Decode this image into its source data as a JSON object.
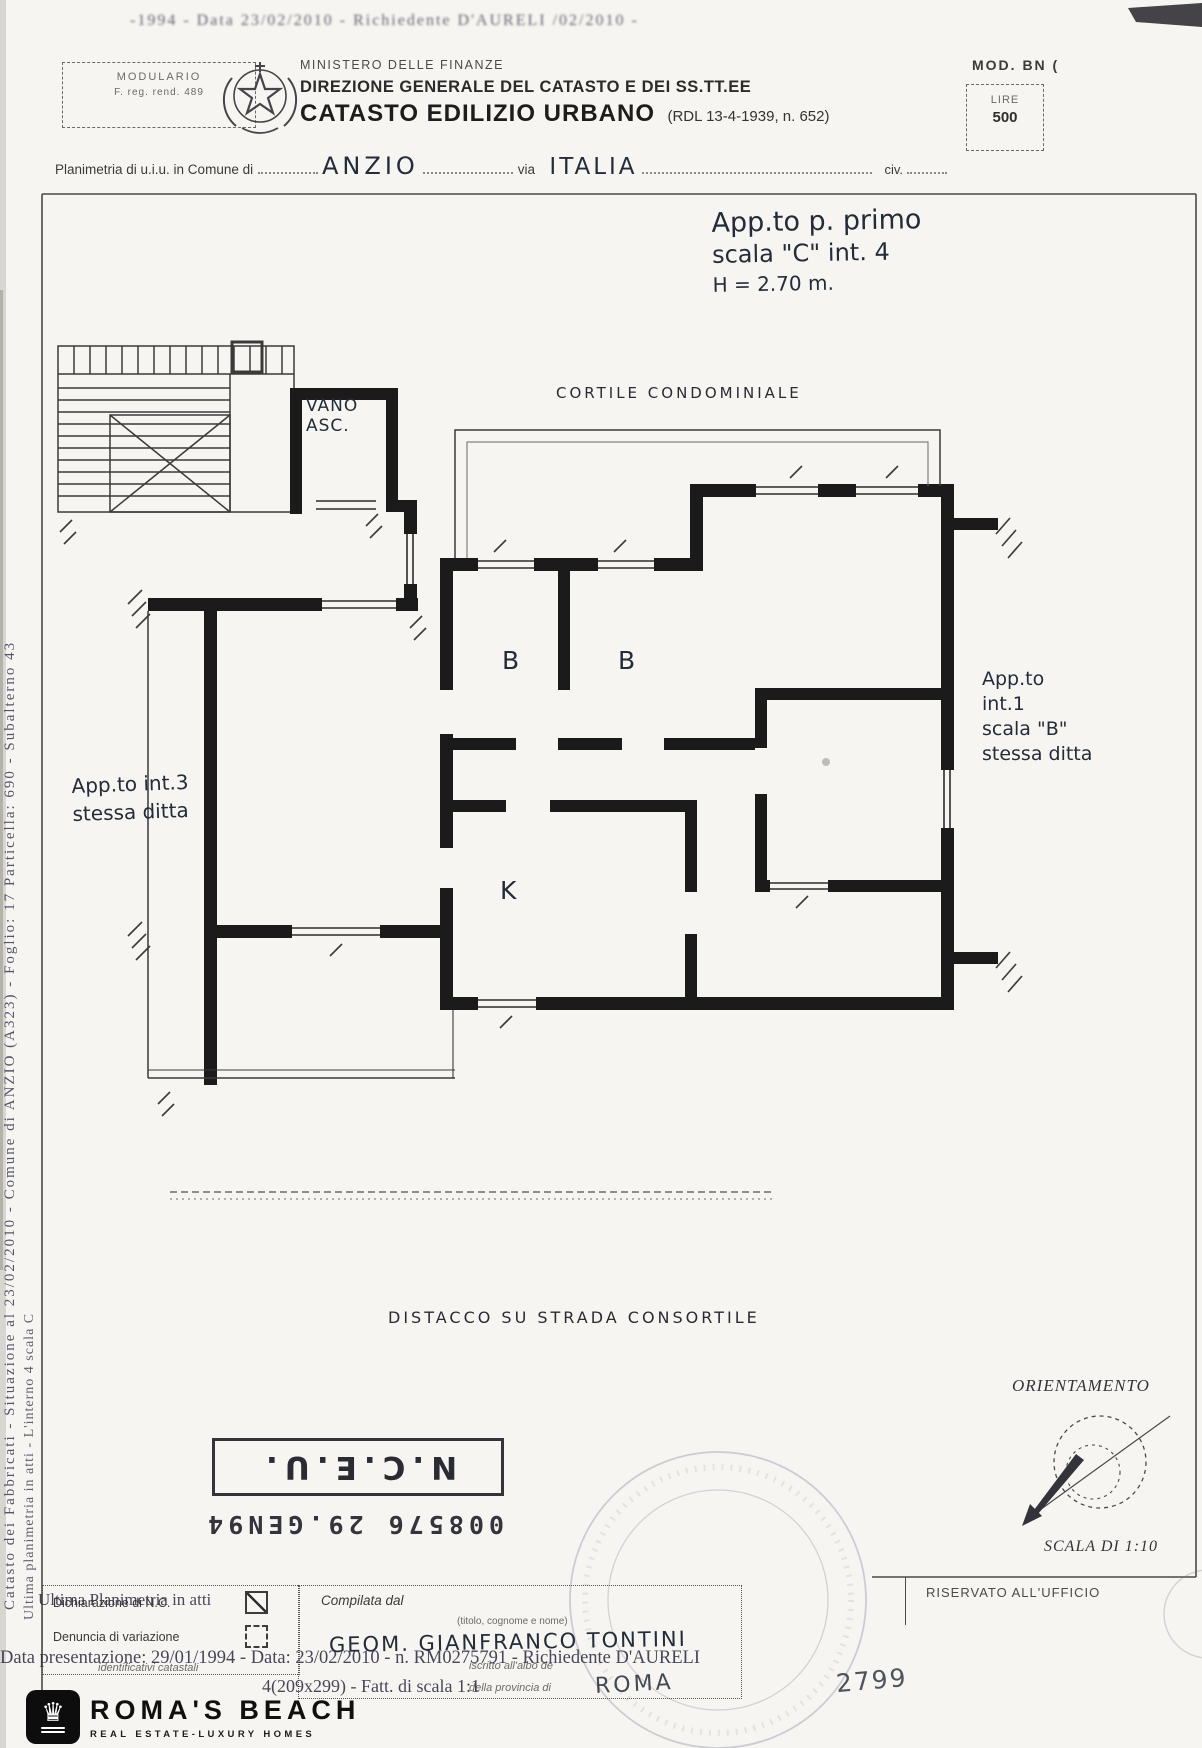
{
  "header": {
    "modulario_line1": "MODULARIO",
    "modulario_line2": "F. reg. rend. 489",
    "ministry": "MINISTERO DELLE FINANZE",
    "direction": "DIREZIONE GENERALE DEL CATASTO E DEI SS.TT.EE",
    "title": "CATASTO EDILIZIO URBANO",
    "title_ref": "(RDL 13-4-1939, n. 652)",
    "mod_label": "MOD. BN (",
    "lire_label": "LIRE",
    "lire_value": "500"
  },
  "subject": {
    "prefix": "Planimetria di u.i.u. in Comune di",
    "comune": "ANZIO",
    "via_label": "via",
    "via_value": "ITALIA",
    "civ_label": "civ."
  },
  "annotation": {
    "line1": "App.to  p. primo",
    "line2": "scala \"C\"    int. 4",
    "line3": "H = 2.70 m."
  },
  "plan": {
    "cortile": "CORTILE CONDOMINIALE",
    "vano_line1": "VANO",
    "vano_line2": "ASC.",
    "room_b1": "B",
    "room_b2": "B",
    "room_k": "K",
    "left_apartment": {
      "line1": "App.to int.3",
      "line2": "stessa ditta"
    },
    "right_apartment": {
      "line1": "App.to",
      "line2": "int.1",
      "line3": "scala \"B\"",
      "line4": "stessa ditta"
    },
    "distacco": "DISTACCO  SU  STRADA  CONSORTILE"
  },
  "orientation": {
    "title": "ORIENTAMENTO",
    "scale": "SCALA DI 1:10"
  },
  "nceu_stamp": {
    "number_line": "008576      29.GEN94",
    "title": "N.C.E.U."
  },
  "office_box": {
    "label": "RISERVATO ALL'UFFICIO"
  },
  "form": {
    "declaration_label": "Dichiarazione di N.C.",
    "variation_label": "Denuncia di variazione",
    "identificativi_label": "identificativi catastali",
    "compiler_label": "Compilata dal",
    "compiler_hint": "(titolo, cognome e nome)",
    "technician": "GEOM. GIANFRANCO TONTINI",
    "albo_label": "iscritto all'albo de",
    "province_label": "della provincia di",
    "province_value": "ROMA",
    "register_number": "2799"
  },
  "overlays": {
    "top_line": "-1994 - Data 23/02/2010 -  Richiedente D'AURELI /02/2010 -",
    "ultima": "Ultima Planimetria in atti",
    "data_line": "Data presentazione: 29/01/1994 - Data: 23/02/2010 - n. RM0275791 - Richiedente D'AURELI",
    "formato_line": "4(209x299) - Fatt. di scala 1:1",
    "margin_outer": "Catasto dei Fabbricati - Situazione al 23/02/2010 - Comune di ANZIO (A323) - Foglio: 17 Particella: 690 - Subalterno 43",
    "margin_inner": "Ultima planimetria in atti - L'interno 4 scala C"
  },
  "logo": {
    "name": "ROMA'S BEACH",
    "tagline": "REAL ESTATE-LUXURY HOMES"
  }
}
